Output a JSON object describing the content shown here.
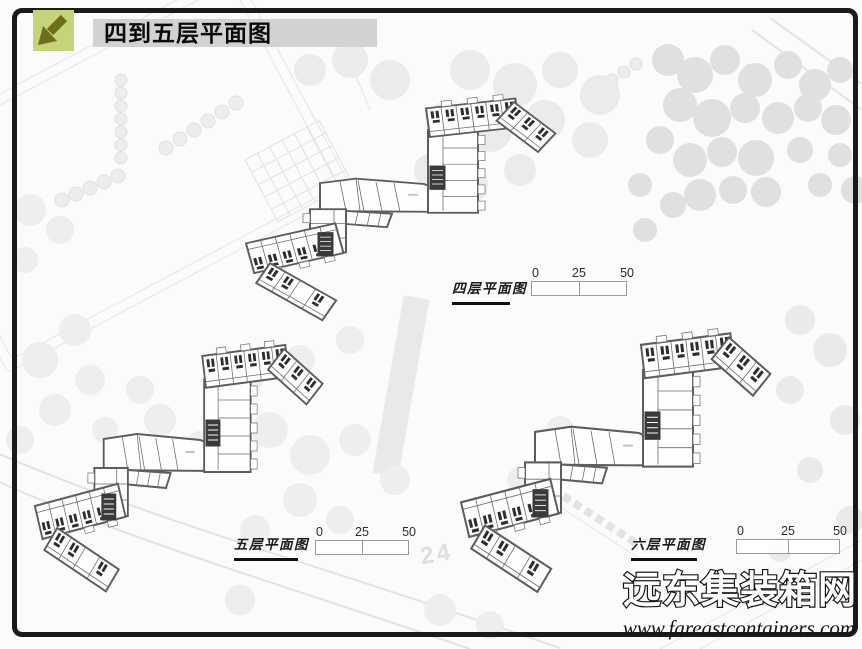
{
  "header": {
    "title": "四到五层平面图",
    "icon": "diagonal-arrow-down-left"
  },
  "plans": [
    {
      "id": "floor-4",
      "label": "四层平面图",
      "scale": {
        "ticks": [
          "0",
          "25",
          "50"
        ]
      }
    },
    {
      "id": "floor-5",
      "label": "五层平面图",
      "scale": {
        "ticks": [
          "0",
          "25",
          "50"
        ]
      }
    },
    {
      "id": "floor-6",
      "label": "六层平面图",
      "scale": {
        "ticks": [
          "0",
          "25",
          "50"
        ]
      }
    }
  ],
  "background": {
    "plot_label": "24"
  },
  "watermark": {
    "site_name": "远东集装箱网",
    "url": "www.fareastcontainers.com"
  },
  "colors": {
    "accent_green": "#c6d37d",
    "arrow_olive": "#6d7018",
    "title_bar_gray": "#d2d2d2",
    "frame_black": "#1a1a1a",
    "plan_line_gray": "#5d5d5d"
  }
}
